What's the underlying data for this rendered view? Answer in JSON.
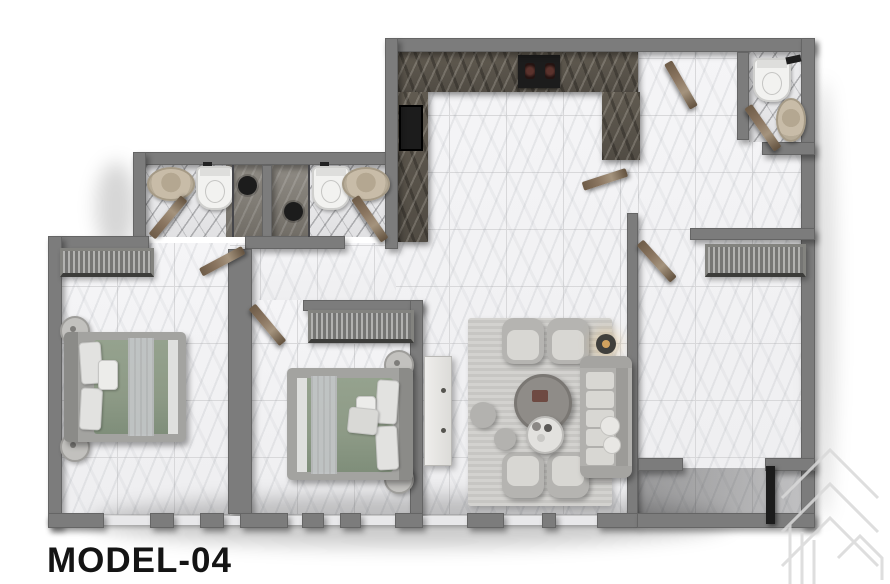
{
  "title": {
    "label": "MODEL-04"
  },
  "palette": {
    "wall": "#7c7c7c",
    "wall-dark": "#5e5e5e",
    "floor-light": "#f3f3f5",
    "tile-line": "#d8d8da",
    "marble-dark": "#605a50",
    "wood": "#8a7560",
    "bed-green": "#8d9a86",
    "fabric-light": "#d8d7d3",
    "fabric-mid": "#b5b4b1",
    "fixture-black": "#1c1c1c",
    "sink-beige": "#c8bca8",
    "glass": "#e8e8ea",
    "watermark": "#d9d9d9",
    "text": "#141414"
  },
  "floorplan": {
    "model": "MODEL-04",
    "rooms": [
      {
        "name": "kitchen",
        "features": [
          "u-shaped-dark-marble-counter",
          "cooktop-2-burners",
          "black-sink-unit"
        ]
      },
      {
        "name": "bathroom-1",
        "features": [
          "oval-sink",
          "toilet",
          "shower",
          "door"
        ]
      },
      {
        "name": "bathroom-2",
        "features": [
          "shower",
          "toilet",
          "oval-sink",
          "door"
        ]
      },
      {
        "name": "bathroom-3",
        "features": [
          "toilet",
          "oval-sink",
          "door"
        ]
      },
      {
        "name": "bedroom-1",
        "features": [
          "double-bed-green-duvet",
          "wardrobe",
          "two-round-nightstands",
          "bottom-windows"
        ]
      },
      {
        "name": "bedroom-2",
        "features": [
          "double-bed-green-duvet",
          "wardrobe",
          "two-round-nightstands",
          "dresser",
          "door",
          "bottom-windows"
        ]
      },
      {
        "name": "living-room",
        "features": [
          "four-armchairs",
          "sofa",
          "round-coffee-tables",
          "poufs",
          "floor-lamp",
          "rug",
          "bottom-windows"
        ]
      },
      {
        "name": "bedroom-3",
        "features": [
          "wardrobe",
          "door"
        ]
      },
      {
        "name": "entry-terrace",
        "features": [
          "dark-glass-door",
          "shaded-floor"
        ]
      },
      {
        "name": "hallway",
        "features": [
          "door-leaves"
        ]
      }
    ]
  }
}
